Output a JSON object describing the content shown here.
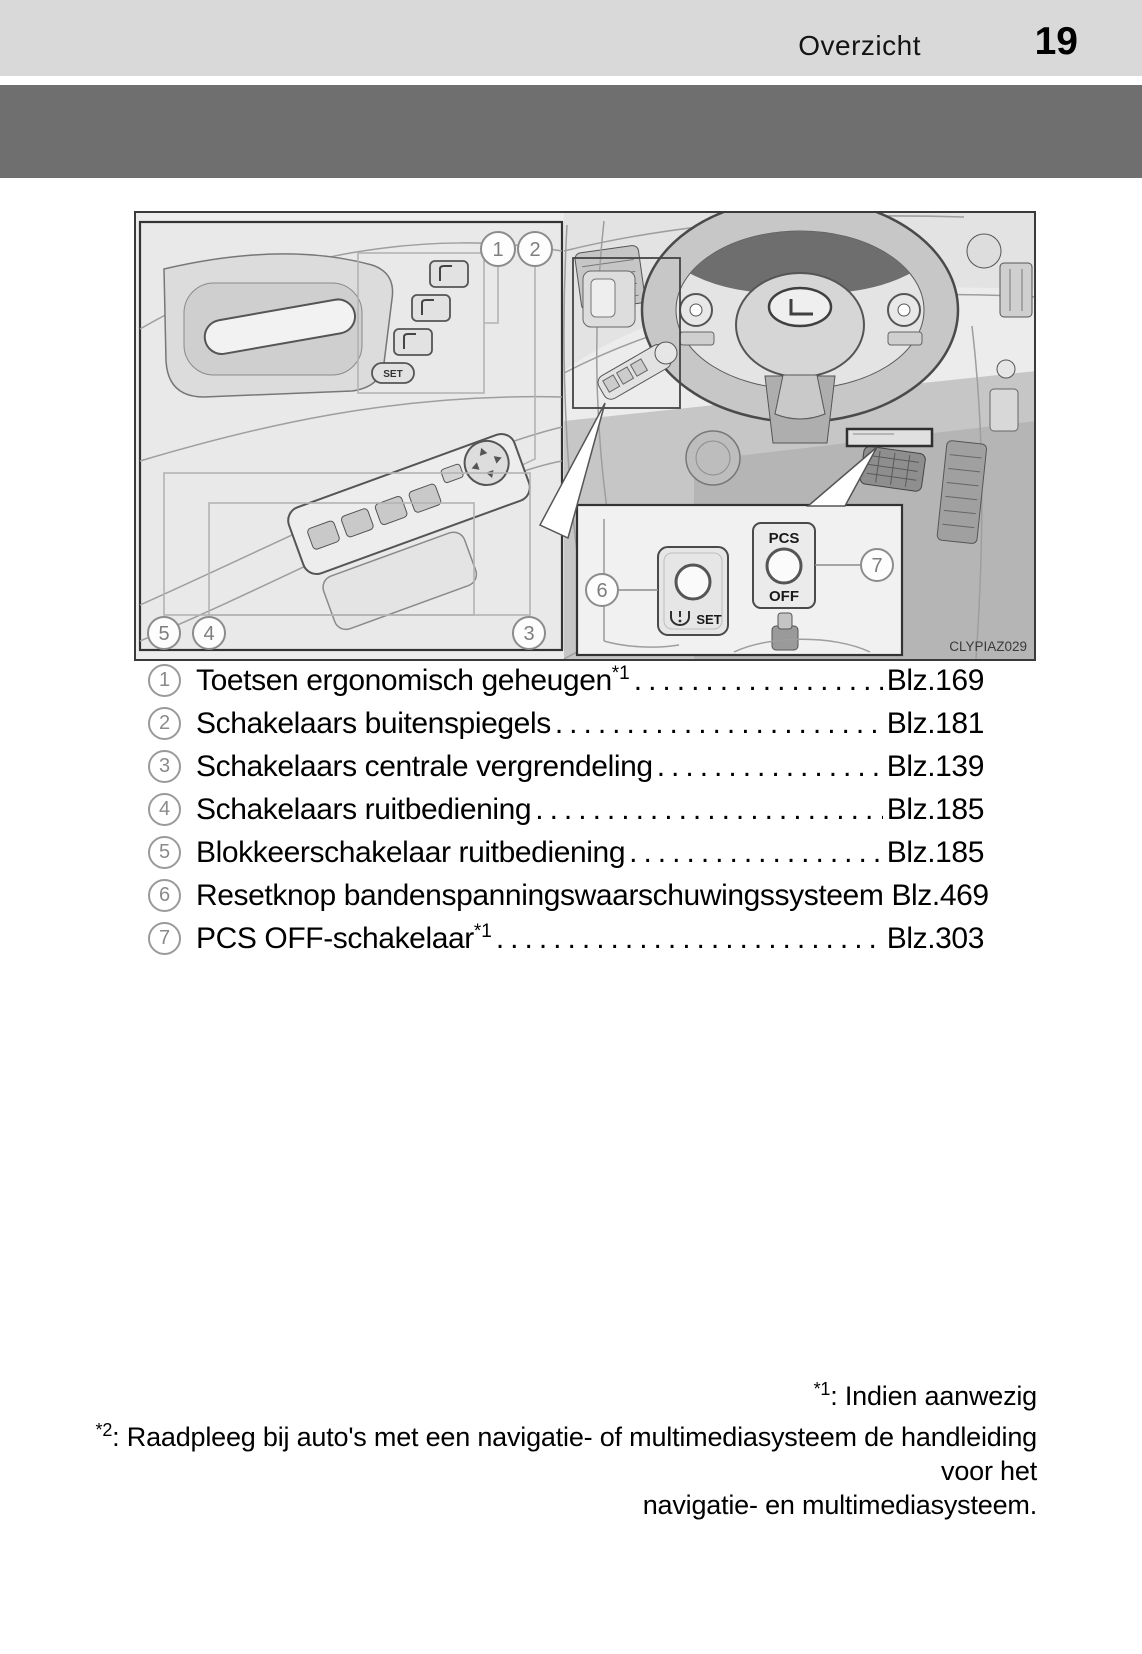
{
  "header": {
    "section_title": "Overzicht",
    "page_number": "19"
  },
  "figure": {
    "code": "CLYPIAZ029",
    "callouts": [
      "1",
      "2",
      "3",
      "4",
      "5",
      "6",
      "7"
    ],
    "inset": {
      "pcs_label_top": "PCS",
      "pcs_label_bottom": "OFF",
      "set_label": "SET"
    },
    "door_memory": {
      "set_label": "SET"
    }
  },
  "legend": {
    "items": [
      {
        "num": "1",
        "label": "Toetsen ergonomisch geheugen",
        "sup": "*1",
        "page": "Blz.169"
      },
      {
        "num": "2",
        "label": "Schakelaars buitenspiegels",
        "sup": "",
        "page": "Blz.181"
      },
      {
        "num": "3",
        "label": "Schakelaars centrale vergrendeling",
        "sup": "",
        "page": "Blz.139"
      },
      {
        "num": "4",
        "label": "Schakelaars ruitbediening",
        "sup": "",
        "page": "Blz.185"
      },
      {
        "num": "5",
        "label": "Blokkeerschakelaar ruitbediening",
        "sup": "",
        "page": "Blz.185"
      },
      {
        "num": "6",
        "label": "Resetknop bandenspanningswaarschuwingssysteem",
        "sup": "",
        "page": "Blz.469"
      },
      {
        "num": "7",
        "label": "PCS OFF-schakelaar",
        "sup": "*1",
        "page": "Blz.303"
      }
    ]
  },
  "footnotes": {
    "note1": {
      "marker": "*1",
      "text": ": Indien aanwezig"
    },
    "note2": {
      "marker": "*2",
      "text_line1": ": Raadpleeg bij auto's met een navigatie- of multimediasysteem de handleiding voor het",
      "text_line2": "navigatie- en multimediasysteem."
    }
  }
}
